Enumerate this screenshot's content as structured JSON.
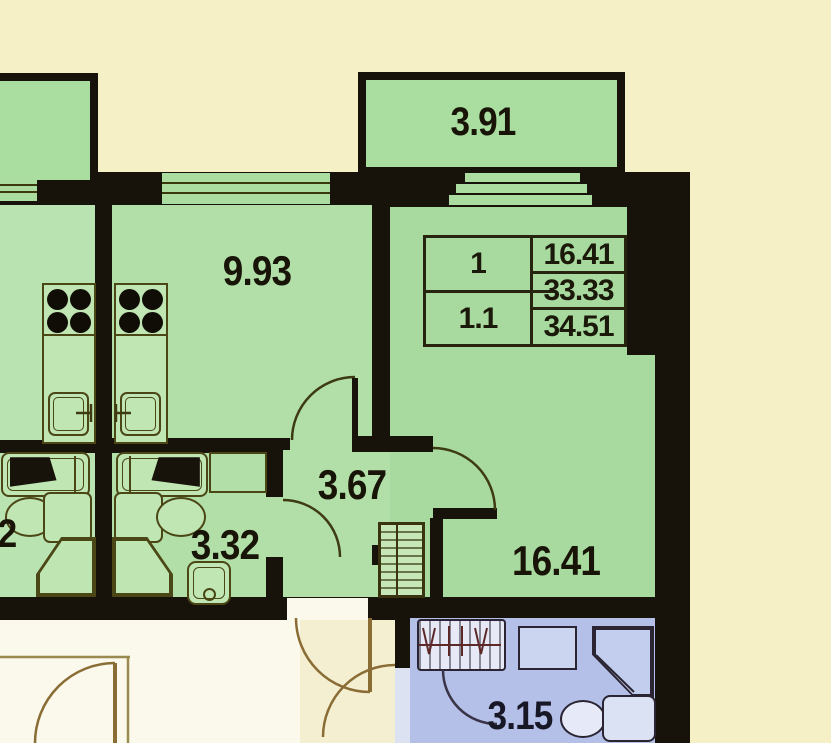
{
  "plan": {
    "stamp": {
      "col_left": [
        "1",
        "1.1"
      ],
      "col_right": [
        "16.41",
        "33.33",
        "34.51"
      ]
    },
    "rooms": {
      "balcony": "3.91",
      "kitchen_living": "9.93",
      "hall": "3.67",
      "bathroom": "3.32",
      "living_room": "16.41",
      "neighbor_fragment": "2",
      "lower_bathroom": "3.15"
    },
    "colors": {
      "background": "#f6f0c6",
      "corridor": "#fbf8ec",
      "wall": "#17120a",
      "room_fill": "#b1dfa7",
      "balcony_fill": "#aadda0",
      "lower_room_fill": "#b4c0e8",
      "fixture_line": "#4b4616",
      "label_text": "#191408"
    }
  }
}
